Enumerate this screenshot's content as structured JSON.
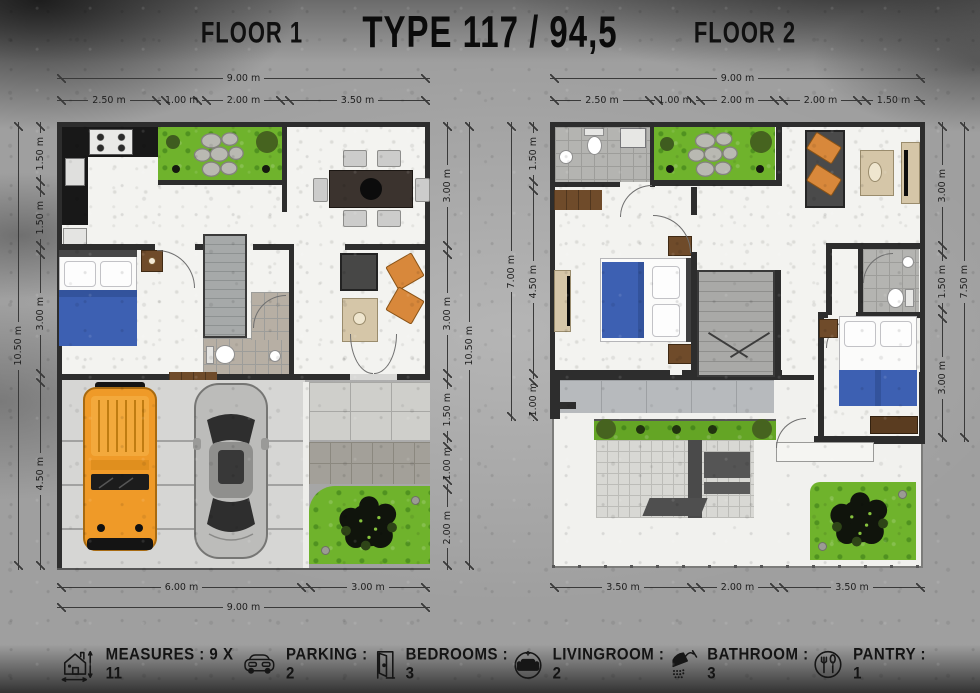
{
  "header": {
    "floor1_label": "FLOOR 1",
    "title": "TYPE 117 / 94,5",
    "floor2_label": "FLOOR 2"
  },
  "floor1": {
    "dims": {
      "top_total": "9.00 m",
      "top_segments": [
        "2.50 m",
        "1.00 m",
        "2.00 m",
        "3.50 m"
      ],
      "left_total": "10.50 m",
      "left_segments": [
        "1.50 m",
        "1.50 m",
        "3.00 m",
        "4.50 m"
      ],
      "right_total": "10.50 m",
      "right_segments": [
        "3.00 m",
        "3.00 m",
        "1.50 m",
        "1.00 m",
        "2.00 m"
      ],
      "bottom_segments": [
        "6.00 m",
        "3.00 m"
      ],
      "bottom_total": "9.00 m"
    }
  },
  "floor2": {
    "dims": {
      "top_total": "9.00 m",
      "top_segments": [
        "2.50 m",
        "1.00 m",
        "2.00 m",
        "2.00 m",
        "1.50 m"
      ],
      "left_total": "7.00 m",
      "left_segments": [
        "1.50 m",
        "4.50 m",
        "1.00 m"
      ],
      "right_total": "7.50 m",
      "right_segments": [
        "3.00 m",
        "1.50 m",
        "3.00 m"
      ],
      "bottom_segments": [
        "3.50 m",
        "2.00 m",
        "3.50 m"
      ]
    }
  },
  "legend": {
    "items": [
      {
        "icon": "house-measure-icon",
        "label": "MEASURES : 9 X 11"
      },
      {
        "icon": "car-icon",
        "label": "PARKING : 2"
      },
      {
        "icon": "door-icon",
        "label": "BEDROOMS : 3"
      },
      {
        "icon": "sofa-icon",
        "label": "LIVINGROOM : 2"
      },
      {
        "icon": "shower-icon",
        "label": "BATHROOM : 3"
      },
      {
        "icon": "cutlery-icon",
        "label": "PANTRY : 1"
      }
    ]
  },
  "colors": {
    "wall": "#2d2d2d",
    "grass": "#6fb32c",
    "bed_blue": "#3d60b2",
    "jeep_orange": "#ef9a28",
    "concrete": "#9f9f9f",
    "floor": "#f3f3f0"
  }
}
